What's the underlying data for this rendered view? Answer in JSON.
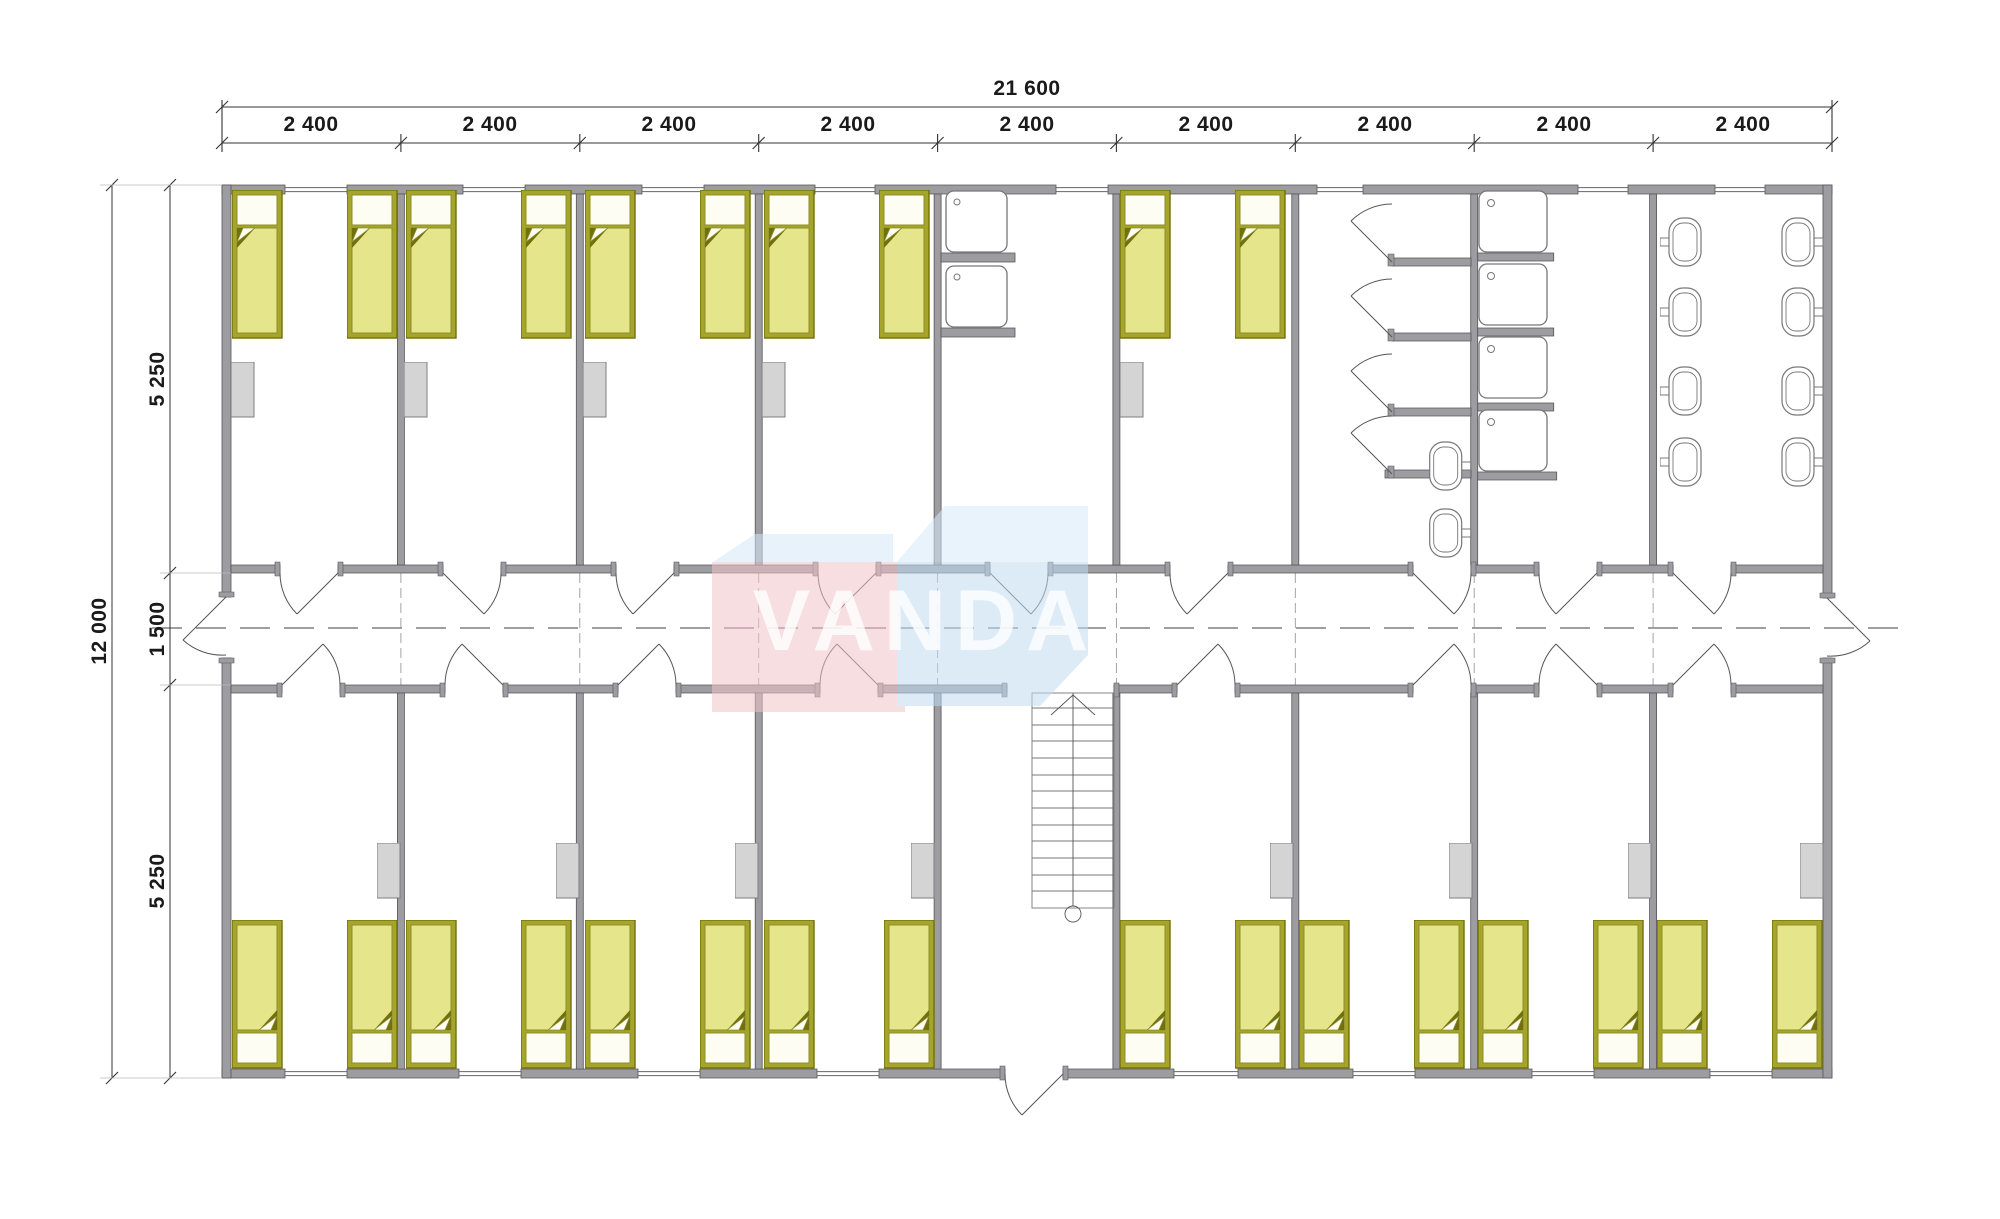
{
  "drawing": {
    "type": "architectural floor plan",
    "units": "mm"
  },
  "watermark": {
    "text": "VANDA",
    "pink": "#f2c4ca",
    "light_blue": "#d8ebfa",
    "blue": "#c2dcf2"
  },
  "dimensions": {
    "overall_width": "21 600",
    "overall_height": "12 000",
    "module_widths": [
      "2 400",
      "2 400",
      "2 400",
      "2 400",
      "2 400",
      "2 400",
      "2 400",
      "2 400",
      "2 400"
    ],
    "left_segments": [
      "5 250",
      "1 500",
      "5 250"
    ]
  },
  "colors": {
    "wall": "#9c9ca1",
    "wall_edge": "#55555a",
    "bed_frame": "#a5a52c",
    "bed_mattress": "#e5e58c",
    "bed_dark": "#70700e",
    "wardrobe": "#d4d4d4",
    "fixture_line": "#777777",
    "dimension_text": "#1a1a1a"
  },
  "contents": {
    "beds": 26,
    "wardrobes": 13,
    "wash_basins": 2,
    "shower_trays": 4,
    "toilets": 10,
    "stairs": 1,
    "corridor": 1
  }
}
